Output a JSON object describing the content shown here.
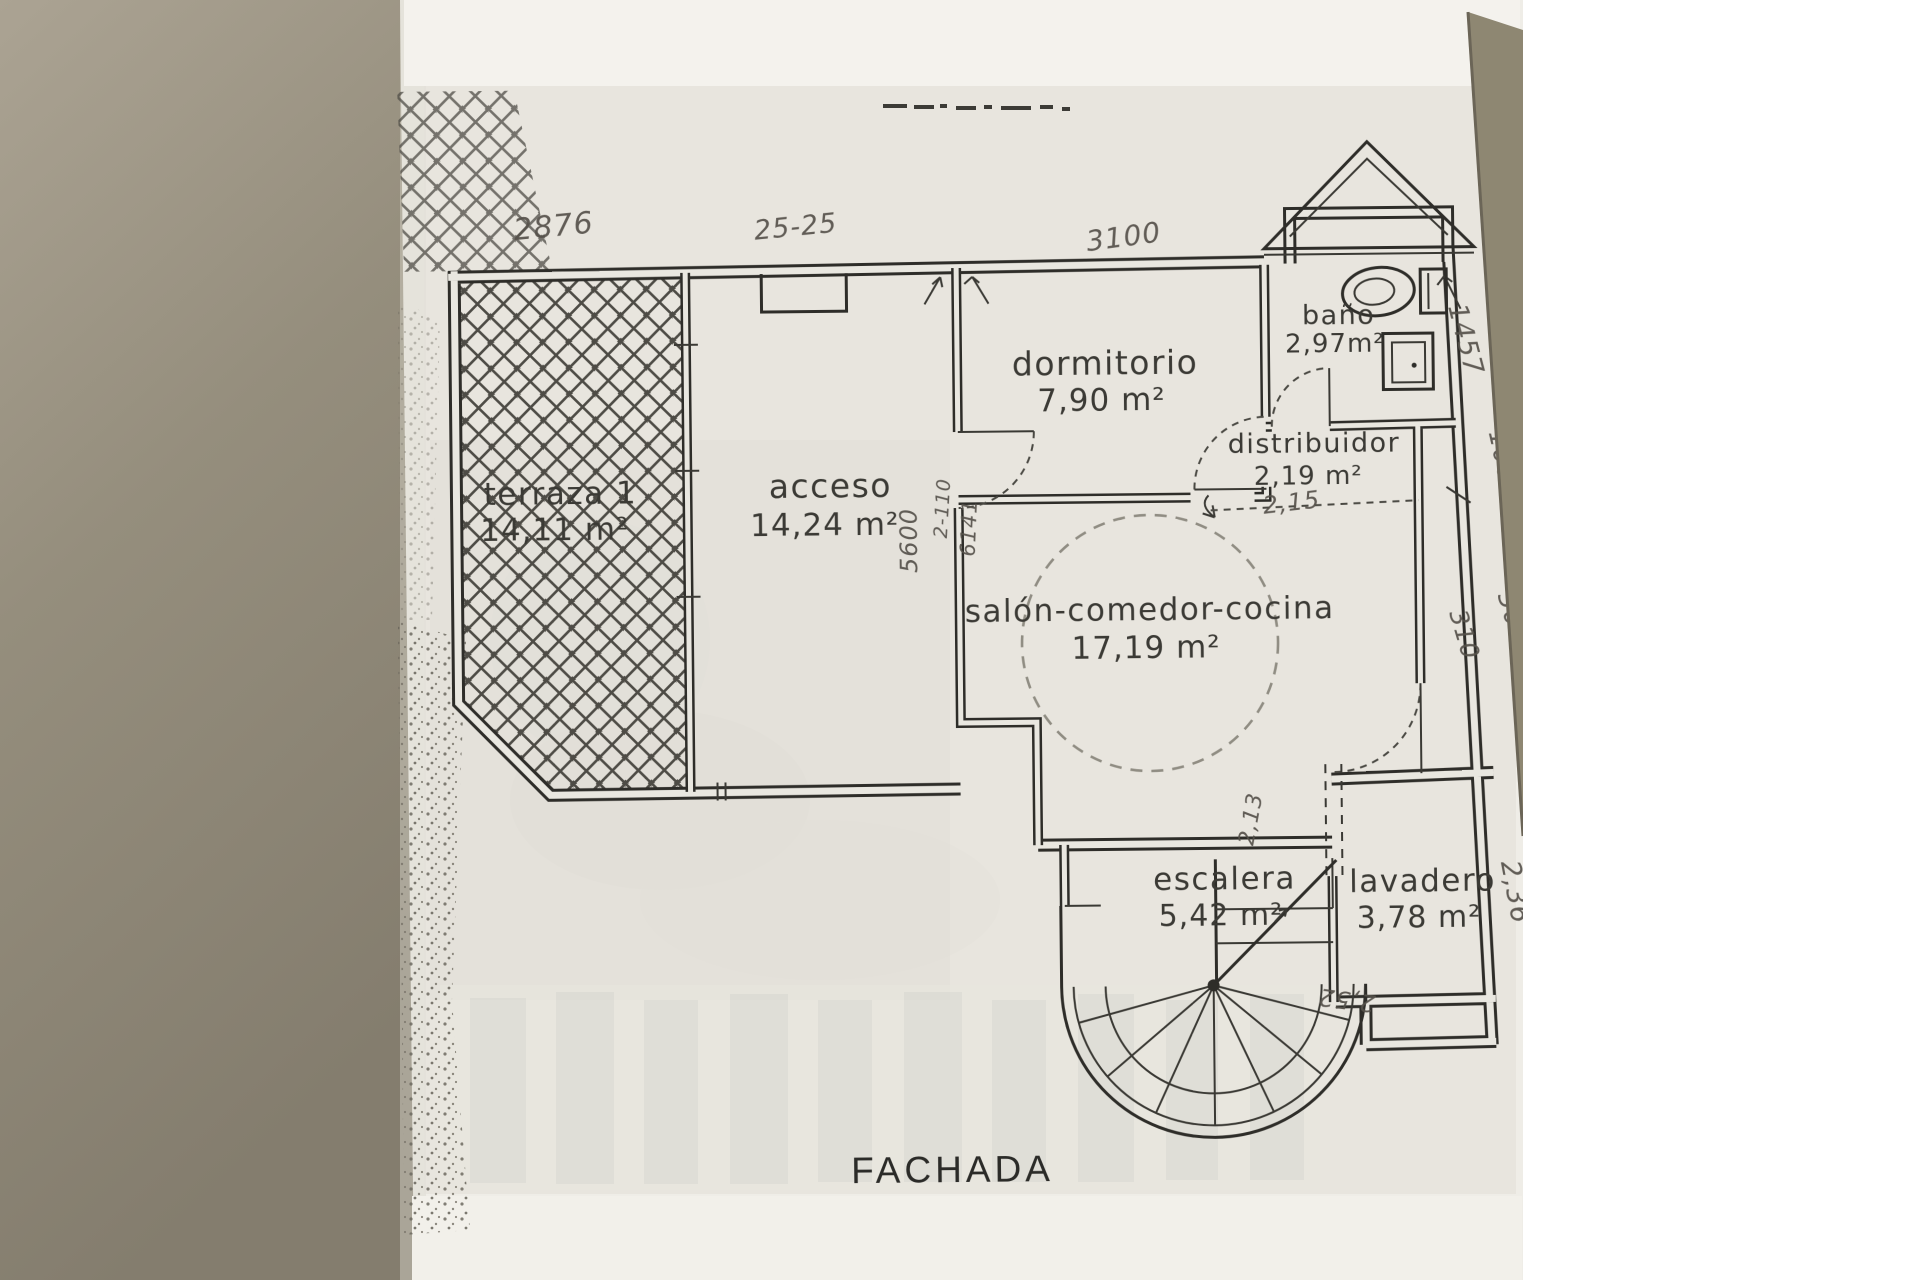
{
  "scene": {
    "desk_color": "#9b947f",
    "paper_color": "#efede7",
    "ink_color": "#2e2d29",
    "pencil_color": "#55514a"
  },
  "plan": {
    "caption": "FACHADA",
    "rooms": [
      {
        "name": "terraza 1",
        "area": "14,11 m²"
      },
      {
        "name": "acceso",
        "area": "14,24 m²"
      },
      {
        "name": "dormitorio",
        "area": "7,90 m²"
      },
      {
        "name": "baño",
        "area": "2,97m²"
      },
      {
        "name": "distribuidor",
        "area": "2,19 m²"
      },
      {
        "name": "salón-comedor-cocina",
        "area": "17,19 m²"
      },
      {
        "name": "escalera",
        "area": "5,42 m²"
      },
      {
        "name": "lavadero",
        "area": "3,78 m²"
      }
    ],
    "hw": [
      "2876",
      "25-25",
      "3100",
      "1457",
      "100",
      "300",
      "310",
      "2,36",
      "5600",
      "2-110",
      "6141",
      "2,15",
      "2,13",
      "2,52"
    ]
  }
}
